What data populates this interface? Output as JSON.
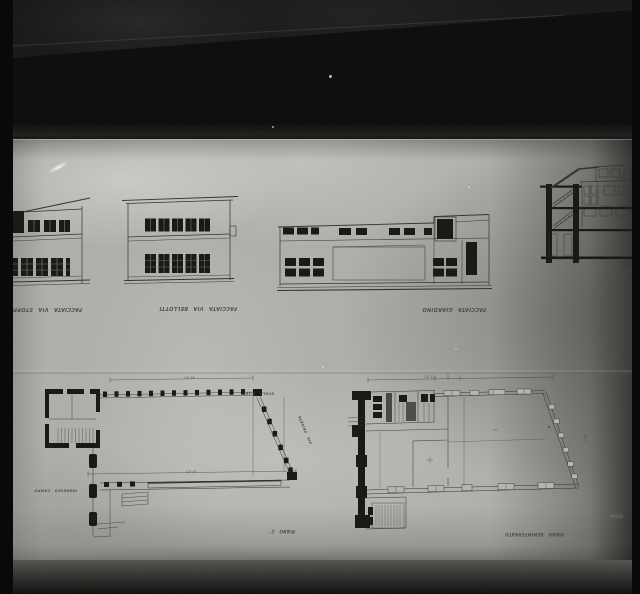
{
  "photo_subject": "negative photograph of architectural drawings (building elevations, section and floor plans)",
  "captions": {
    "elevation_left": "FACCIATA VIA STOPPANI",
    "elevation_middle": "FACCIATA VIA BELLOTTI",
    "elevation_right": "FACCIATA GIARDINO",
    "plans_between_note": "SCALA 1:100",
    "plan_left_note": "INGRESSO CAMPO",
    "plan_left_label": "PIANO 1°",
    "plan_right_label": "PIANO SEMINTERRATO",
    "plan_left_side_note": "VIA PRIVATA"
  },
  "dimensions": {
    "plan_left_top": "44.90",
    "plan_left_mid": "14.45",
    "plan_right_top": "17.50",
    "plan_right_diag": "7.80"
  },
  "film": {
    "stamp_text": "MOD."
  }
}
